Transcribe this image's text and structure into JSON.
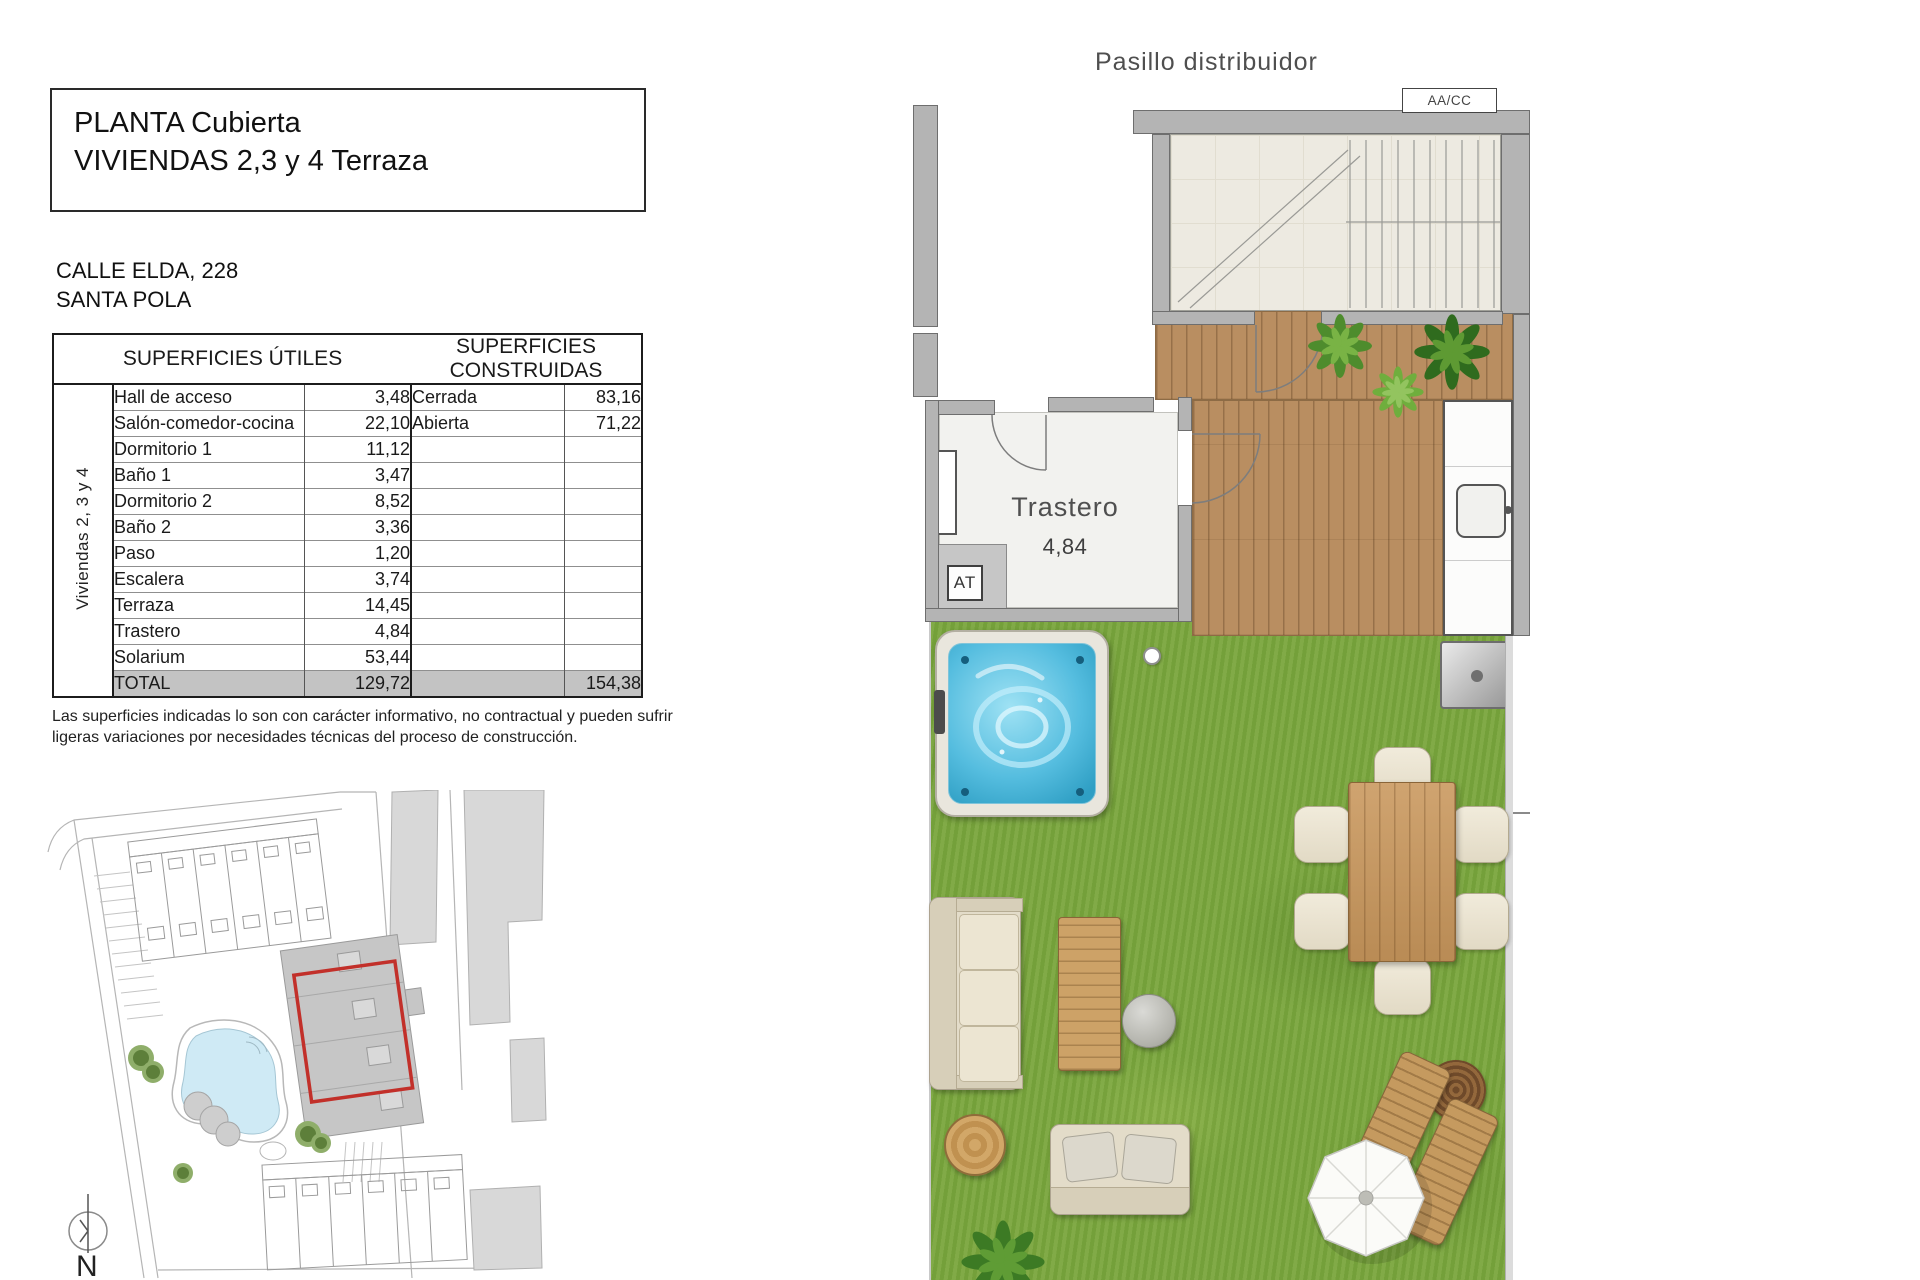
{
  "document": {
    "title_line1": "PLANTA Cubierta",
    "title_line2": "VIVIENDAS 2,3 y 4 Terraza",
    "address_line1": "CALLE ELDA, 228",
    "address_line2": "SANTA POLA",
    "disclaimer_line1": "Las superficies indicadas lo son con carácter informativo, no contractual y pueden sufrir",
    "disclaimer_line2": "ligeras variaciones por necesidades técnicas del proceso de construcción."
  },
  "areas_table": {
    "header_utiles": "SUPERFICIES ÚTILES",
    "header_construidas": "SUPERFICIES CONSTRUIDAS",
    "group_label": "Viviendas 2, 3 y 4",
    "rows": [
      {
        "name": "Hall de acceso",
        "value": "3,48",
        "cname": "Cerrada",
        "cvalue": "83,16"
      },
      {
        "name": "Salón-comedor-cocina",
        "value": "22,10",
        "cname": "Abierta",
        "cvalue": "71,22"
      },
      {
        "name": "Dormitorio 1",
        "value": "11,12",
        "cname": "",
        "cvalue": ""
      },
      {
        "name": "Baño 1",
        "value": "3,47",
        "cname": "",
        "cvalue": ""
      },
      {
        "name": "Dormitorio 2",
        "value": "8,52",
        "cname": "",
        "cvalue": ""
      },
      {
        "name": "Baño 2",
        "value": "3,36",
        "cname": "",
        "cvalue": ""
      },
      {
        "name": "Paso",
        "value": "1,20",
        "cname": "",
        "cvalue": ""
      },
      {
        "name": "Escalera",
        "value": "3,74",
        "cname": "",
        "cvalue": ""
      },
      {
        "name": "Terraza",
        "value": "14,45",
        "cname": "",
        "cvalue": ""
      },
      {
        "name": "Trastero",
        "value": "4,84",
        "cname": "",
        "cvalue": ""
      },
      {
        "name": "Solarium",
        "value": "53,44",
        "cname": "",
        "cvalue": ""
      }
    ],
    "total": {
      "label": "TOTAL",
      "value": "129,72",
      "cvalue": "154,38"
    }
  },
  "floor_plan": {
    "corridor_label": "Pasillo distribuidor",
    "aacc_label": "AA/CC",
    "room_label": "Trastero",
    "room_area": "4,84",
    "at_label": "AT"
  },
  "site_plan": {
    "north_label": "N"
  },
  "colors": {
    "grass": "#7aa63d",
    "deck": "#b98e61",
    "wall": "#b4b4b4",
    "jacuzzi_water": "#55bddf",
    "pool": "#cfeaf5",
    "highlight_red": "#c2302a",
    "total_row_bg": "#c3c3c3"
  }
}
